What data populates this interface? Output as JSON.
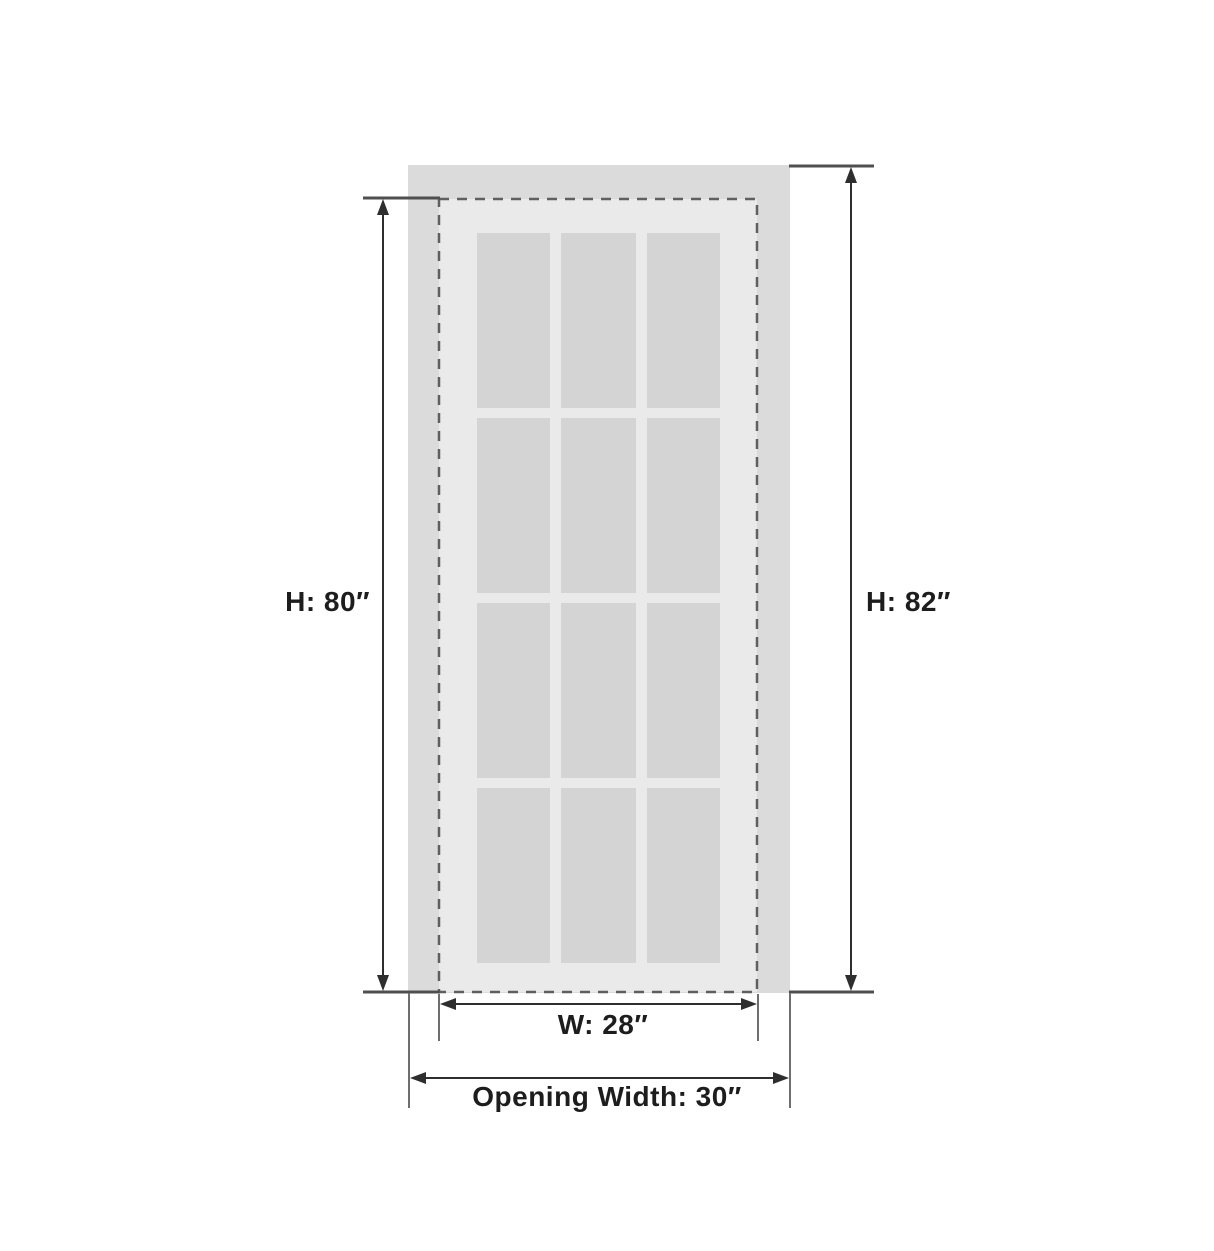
{
  "diagram": {
    "title": "door-size-diagram",
    "labels": {
      "door_height": "H: 80″",
      "opening_height": "H: 82″",
      "door_width": "W: 28″",
      "opening_width": "Opening Width: 30″"
    },
    "measurements": {
      "door_height_in": 80,
      "opening_height_in": 82,
      "door_width_in": 28,
      "opening_width_in": 30
    },
    "glass_grid": {
      "rows": 4,
      "columns": 3,
      "pane_count": 12
    },
    "colors": {
      "background": "#ffffff",
      "opening_fill": "#dbdbdb",
      "door_fill": "#eaeaea",
      "pane_fill": "#d4d4d4",
      "dash_stroke": "#5f5f5f",
      "dimension_line": "#2e2e2e",
      "extension_tick": "#4f4f4f",
      "extension_line": "#6e6e6e",
      "text": "#1d1d1d"
    }
  }
}
